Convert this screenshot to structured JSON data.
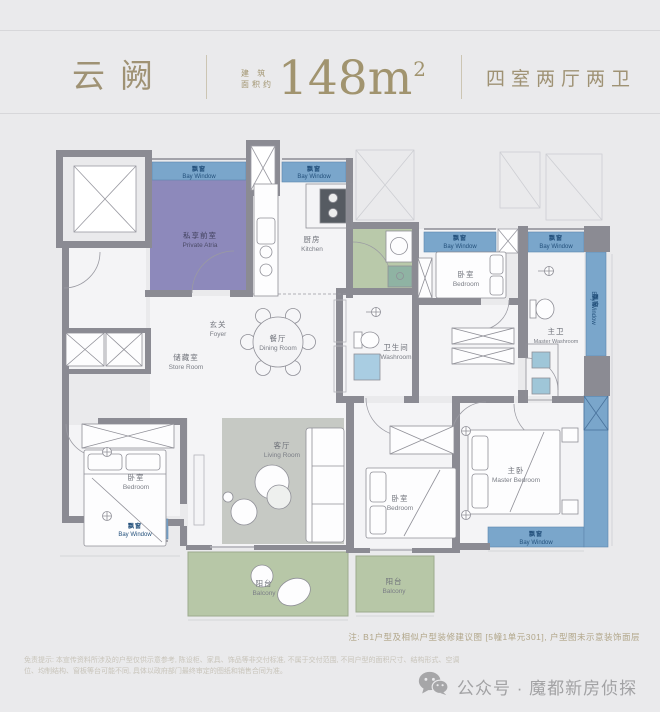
{
  "header": {
    "title": "云阙",
    "area_label_top": "建 筑",
    "area_label_bottom": "面积约",
    "area_value": "148m",
    "area_superscript": "2",
    "layout_type": "四室两厅两卫"
  },
  "plan": {
    "bay_window": {
      "zh": "飘窗",
      "en": "Bay Window"
    },
    "private_atria": {
      "zh": "私享前室",
      "en": "Private Atria"
    },
    "kitchen": {
      "zh": "厨房",
      "en": "Kitchen"
    },
    "foyer": {
      "zh": "玄关",
      "en": "Foyer"
    },
    "dining_room": {
      "zh": "餐厅",
      "en": "Dining Room"
    },
    "store_room": {
      "zh": "储藏室",
      "en": "Store Room"
    },
    "washroom": {
      "zh": "卫生间",
      "en": "Washroom"
    },
    "master_washroom": {
      "zh": "主卫",
      "en": "Master Washroom"
    },
    "bedroom": {
      "zh": "卧室",
      "en": "Bedroom"
    },
    "master_bedroom": {
      "zh": "主卧",
      "en": "Master Bedroom"
    },
    "living_room": {
      "zh": "客厅",
      "en": "Living Room"
    },
    "balcony": {
      "zh": "阳台",
      "en": "Balcony"
    }
  },
  "notes": {
    "plan_note": "注: B1户型及相似户型装修建议图 [5幢1单元301], 户型图未示意装饰面层",
    "disclaimer_line1": "免责提示: 本宣传资料所涉及的户型仅供示意参考, 陈设柜、家具、饰品等非交付标准, 不属于交付范围, 不同户型的面积尺寸、结构形式、空调",
    "disclaimer_line2": "位、均制结构、窗板等台可能不同, 具体以政府部门最终审定的图纸和销售合同为准。"
  },
  "footer": {
    "wechat_label": "公众号 · 魔都新房侦探"
  },
  "colors": {
    "accent_gold": "#9f9274",
    "wall_gray": "#8b8b93",
    "bay_blue": "#7aa6cb",
    "bay_text": "#24517c",
    "atria_purple": "#8d89bb",
    "balcony_green": "#b7c7a7",
    "utility_green": "#b9c9aa",
    "rug_gray": "#c6c9c4"
  }
}
